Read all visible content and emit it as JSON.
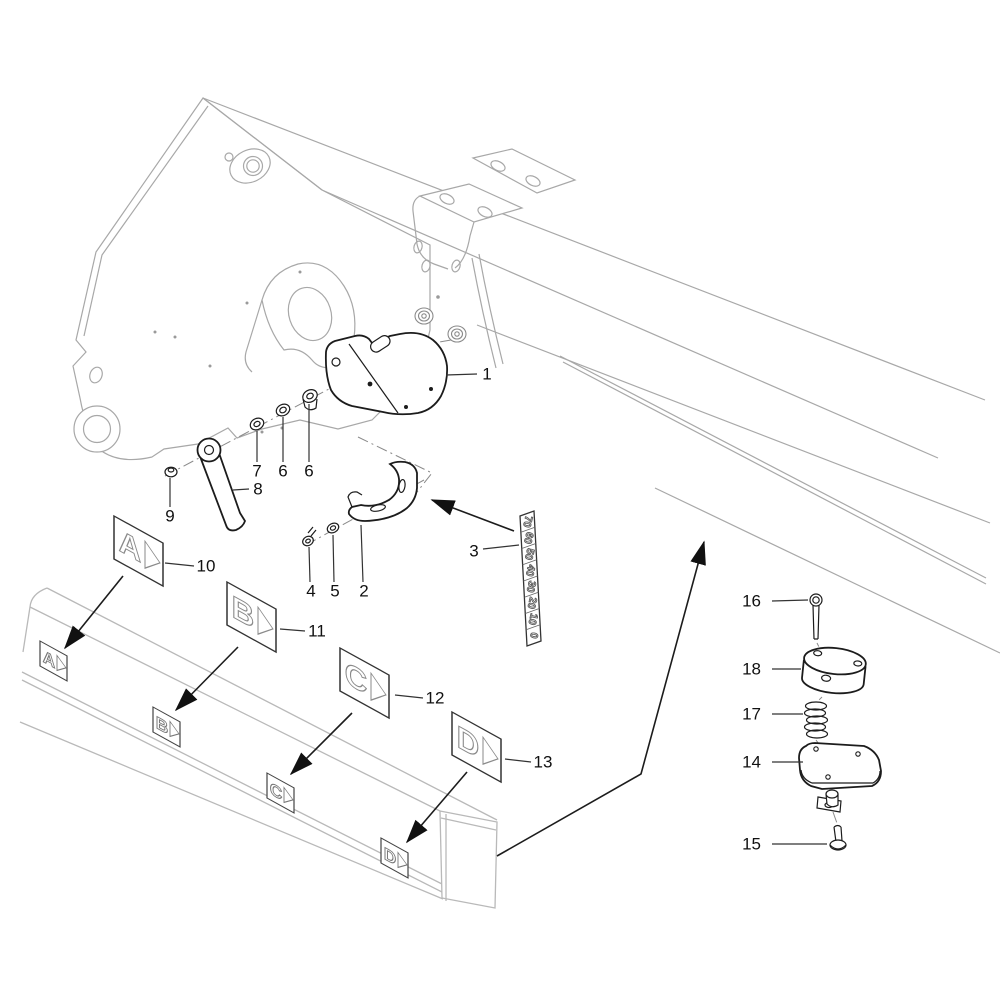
{
  "diagram": {
    "type": "exploded-parts-diagram",
    "colors": {
      "background": "#ffffff",
      "machine_line": "#a8a8a8",
      "part_line": "#1c1c1c",
      "label_color": "#111111"
    },
    "callouts": {
      "c1": "1",
      "c2": "2",
      "c3": "3",
      "c4": "4",
      "c5": "5",
      "c6a": "6",
      "c6b": "6",
      "c7": "7",
      "c8": "8",
      "c9": "9",
      "c10": "10",
      "c11": "11",
      "c12": "12",
      "c13": "13",
      "c14": "14",
      "c15": "15",
      "c16": "16",
      "c17": "17",
      "c18": "18"
    },
    "scale_decal": {
      "values": [
        "70",
        "60",
        "50",
        "40",
        "30",
        "20",
        "10",
        "0"
      ]
    },
    "decals": {
      "a": "A",
      "b": "B",
      "c": "C",
      "d": "D"
    }
  }
}
